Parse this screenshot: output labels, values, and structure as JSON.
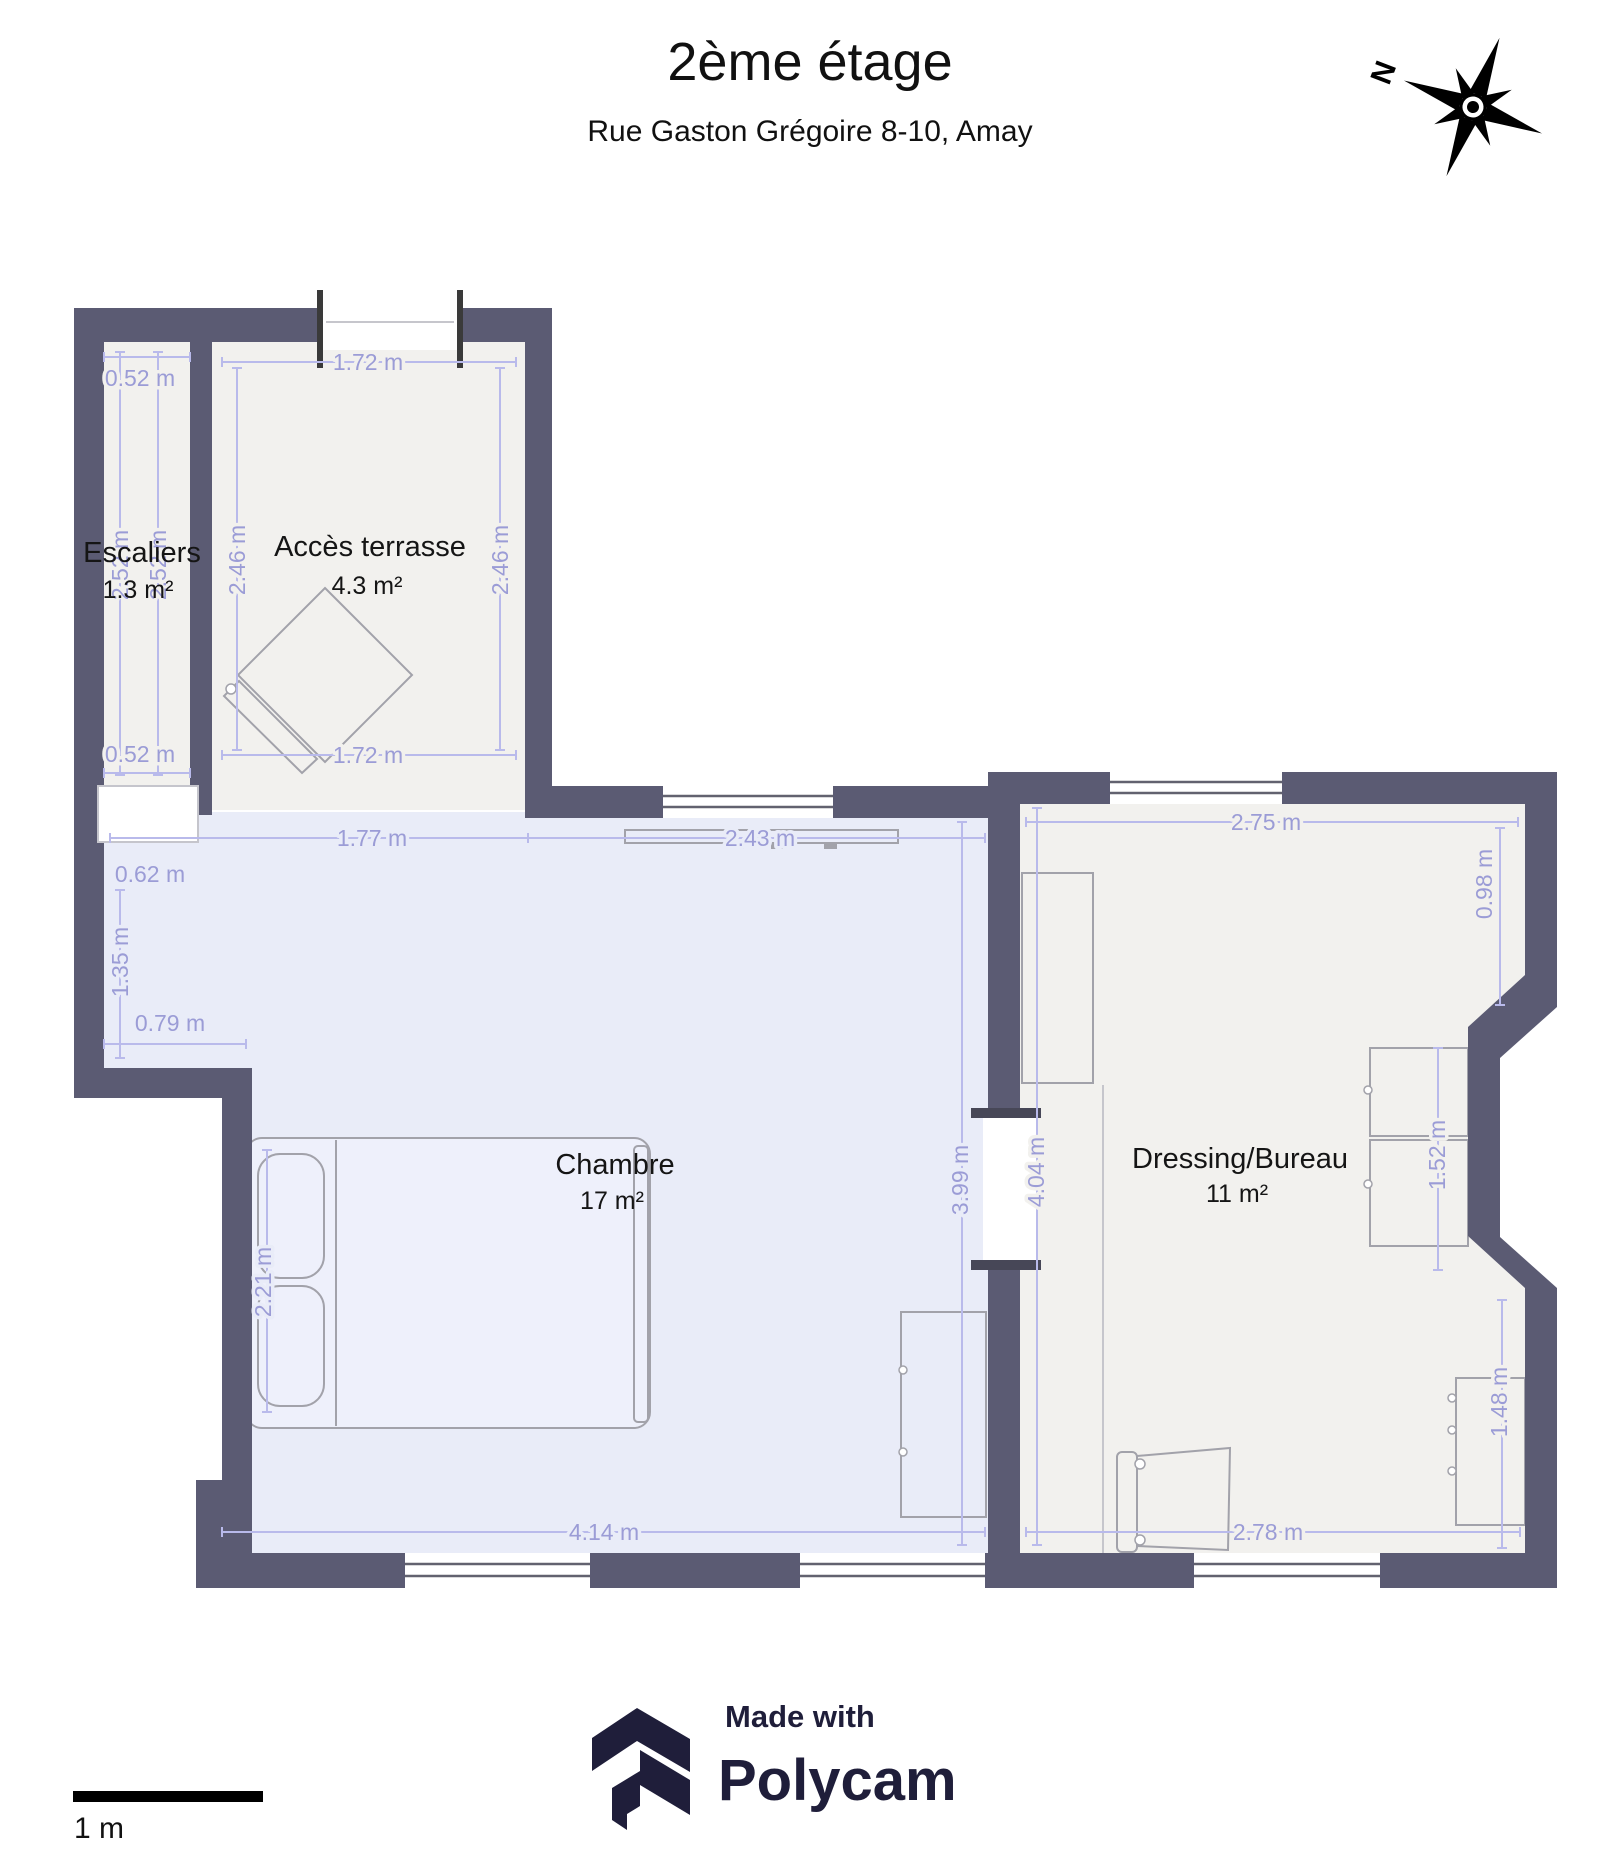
{
  "header": {
    "title": "2ème étage",
    "subtitle": "Rue Gaston Grégoire 8-10, Amay"
  },
  "compass": {
    "north_label": "N"
  },
  "rooms": {
    "escaliers": {
      "name": "Escaliers",
      "area": "1.3 m²"
    },
    "acces_terrasse": {
      "name": "Accès terrasse",
      "area": "4.3 m²"
    },
    "chambre": {
      "name": "Chambre",
      "area": "17 m²"
    },
    "dressing_bureau": {
      "name": "Dressing/Bureau",
      "area": "11 m²"
    }
  },
  "dims": {
    "stairs_top": "0.52 m",
    "stairs_left": "2.52 m",
    "stairs_right": "2.52 m",
    "stairs_bottom": "0.52 m",
    "terrace_top": "1.72 m",
    "terrace_left": "2.46 m",
    "terrace_right": "2.46 m",
    "terrace_bottom": "1.72 m",
    "chambre_top_left": "1.77 m",
    "chambre_top_right": "2.43 m",
    "alcove_width": "0.62 m",
    "alcove_height": "1.35 m",
    "step_width": "0.79 m",
    "bed_length": "2.21 m",
    "chambre_right": "3.99 m",
    "chambre_bottom": "4.14 m",
    "dressing_left": "4.04 m",
    "dressing_top": "2.75 m",
    "dressing_right_top": "0.98 m",
    "dressing_right_mid": "1.52 m",
    "dressing_right_bottom": "1.48 m",
    "dressing_bottom": "2.78 m"
  },
  "scale_bar": {
    "label": "1 m"
  },
  "footer": {
    "made_with": "Made with",
    "brand": "Polycam"
  },
  "colors": {
    "wall": "#5b5b73",
    "floor": "#f2f1ee",
    "floor_chambre": "#e9ecf8",
    "dim_line": "#b9baeb",
    "dim_text": "#9b9cd6",
    "logo": "#1f1e3a"
  }
}
